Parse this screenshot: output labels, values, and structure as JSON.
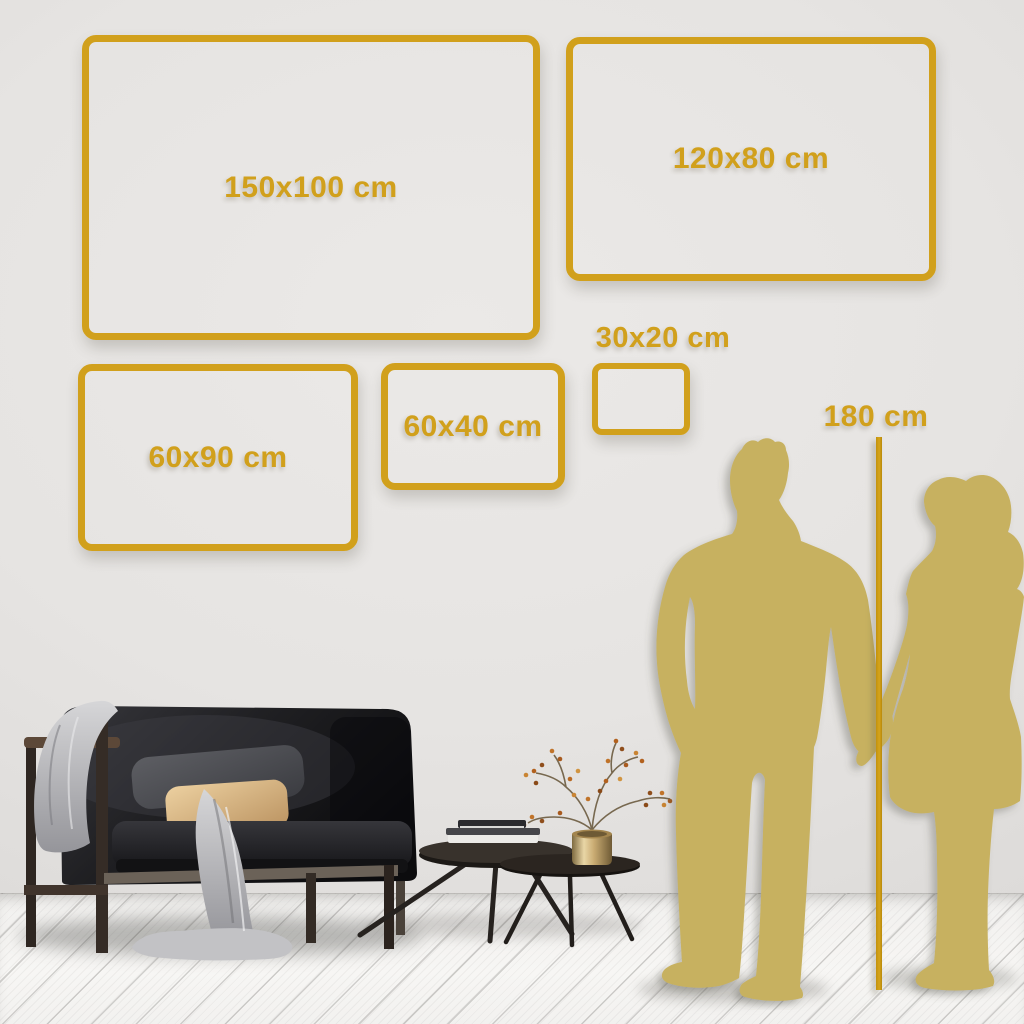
{
  "scene": {
    "description": "Wall art size guide in a living room",
    "sizes": [
      {
        "id": "150x100",
        "label": "150x100 cm",
        "width_cm": 150,
        "height_cm": 100
      },
      {
        "id": "120x80",
        "label": "120x80 cm",
        "width_cm": 120,
        "height_cm": 80
      },
      {
        "id": "60x90",
        "label": "60x90 cm",
        "width_cm": 60,
        "height_cm": 90
      },
      {
        "id": "60x40",
        "label": "60x40 cm",
        "width_cm": 60,
        "height_cm": 40
      },
      {
        "id": "30x20",
        "label": "30x20 cm",
        "width_cm": 30,
        "height_cm": 20
      }
    ],
    "height_marker": {
      "label": "180 cm",
      "value_cm": 180
    },
    "colors": {
      "accent_gold": "#d1a01c",
      "silhouette_gold": "#c7b160",
      "wall_gray": "#e6e4e2",
      "floor_white": "#f6f5f3",
      "sofa_dark": "#1a1a1d",
      "pillow_tan": "#d9b98b",
      "blanket_gray": "#c9c9cb"
    },
    "objects": [
      "sofa",
      "blanket",
      "gray-pillow",
      "tan-pillow",
      "coffee-table-large",
      "coffee-table-small",
      "books",
      "brass-vase",
      "dried-branch",
      "man-silhouette",
      "woman-silhouette",
      "height-line"
    ]
  }
}
